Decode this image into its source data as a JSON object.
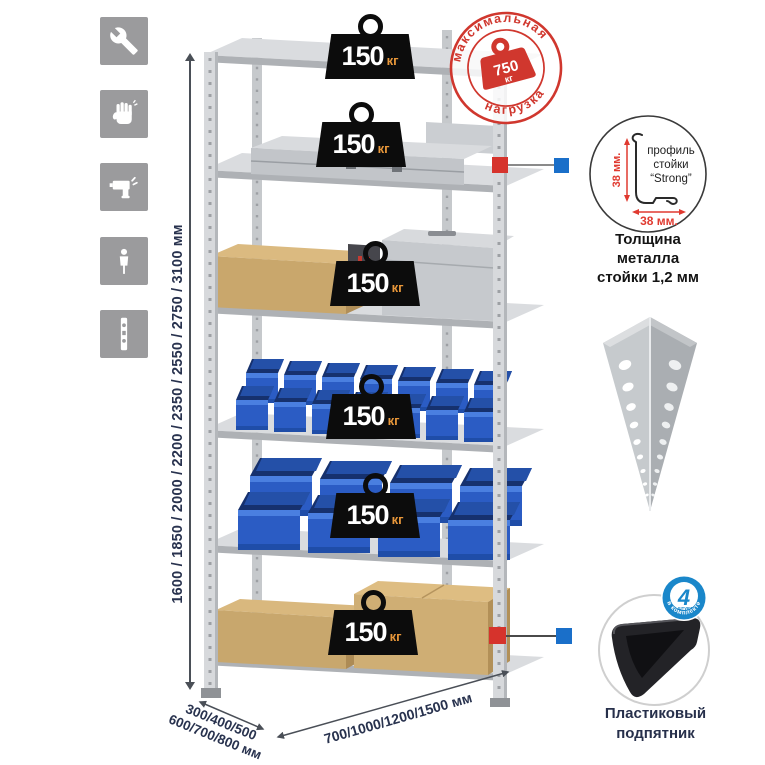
{
  "page": {
    "background": "#ffffff"
  },
  "assembly_icons": {
    "items": [
      {
        "icon": "wrench"
      },
      {
        "icon": "work-gloves"
      },
      {
        "icon": "drill"
      },
      {
        "icon": "person-height"
      },
      {
        "icon": "rack-post"
      }
    ]
  },
  "height_dimension": {
    "label": "1600 / 1850 / 2000 / 2200 / 2350 / 2550 / 2750 / 3100 мм"
  },
  "rack": {
    "shelves": [
      {
        "load_value": "150",
        "load_unit": "кг"
      },
      {
        "load_value": "150",
        "load_unit": "кг"
      },
      {
        "load_value": "150",
        "load_unit": "кг"
      },
      {
        "load_value": "150",
        "load_unit": "кг"
      },
      {
        "load_value": "150",
        "load_unit": "кг"
      },
      {
        "load_value": "150",
        "load_unit": "кг"
      }
    ]
  },
  "max_load_stamp": {
    "arc_top": "максимальная",
    "arc_bottom": "нагрузка",
    "value": "750",
    "unit": "кг"
  },
  "profile_detail": {
    "dim_vertical": "38 мм.",
    "dim_horizontal": "38 мм.",
    "label_line1": "профиль",
    "label_line2": "стойки",
    "label_line3": "“Strong”",
    "caption_line1": "Толщина металла",
    "caption_line2": "стойки 1,2 мм"
  },
  "foot_detail": {
    "badge_value": "4",
    "badge_sub": "штуки",
    "badge_arc": "в комплекте",
    "caption_line1": "Пластиковый",
    "caption_line2": "подпятник"
  },
  "depth_dimension": {
    "line1": "300/400/500",
    "line2": "600/700/800 мм"
  },
  "width_dimension": {
    "label": "700/1000/1200/1500 мм"
  },
  "colors": {
    "accent_red": "#d0372e",
    "accent_blue": "#1a87ca",
    "bin_blue": "#2b5cc4",
    "weight_black": "#0c0c0c",
    "weight_unit_orange": "#e8973a",
    "metal_gray": "#c6c9cc",
    "icon_tile_gray": "#9b9b9d",
    "dimension_text": "#28324e"
  }
}
